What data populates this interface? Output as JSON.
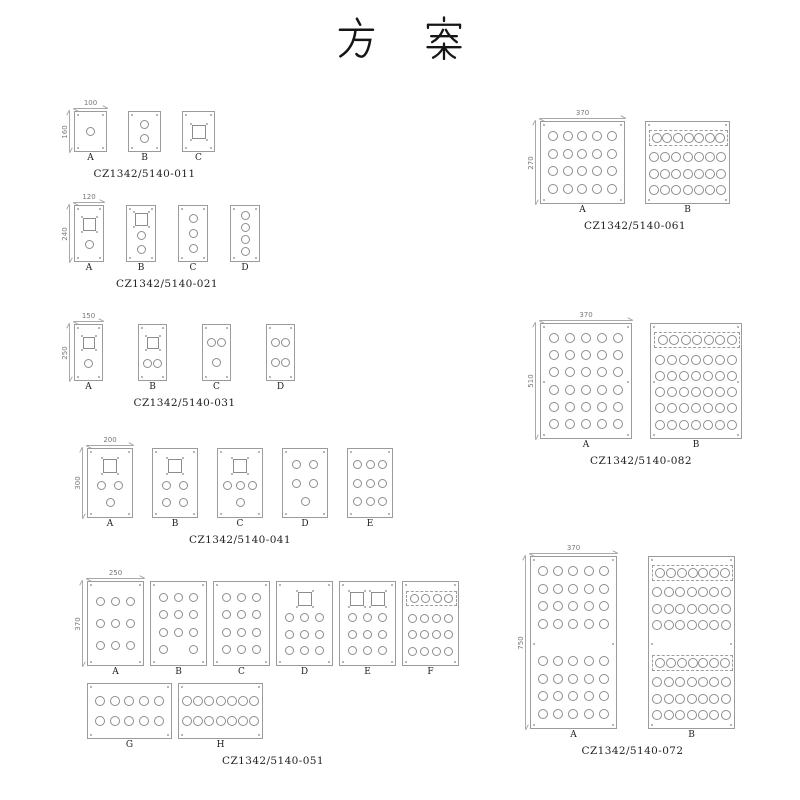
{
  "title": "方 案",
  "colors": {
    "line": "#9b9b9b",
    "hole": "#8d8d8d",
    "text": "#222222",
    "dim": "#787878"
  },
  "groups": [
    {
      "code": "CZ1342/5140-011",
      "dim_width": "100",
      "dim_height": "160",
      "layout": {
        "x": 62,
        "y": 100
      },
      "panelRows": [
        {
          "w": 33,
          "h": 41,
          "gap": 21,
          "circ": 9,
          "sq": 14,
          "panels": [
            {
              "letter": "A",
              "rows": [
                "c"
              ]
            },
            {
              "letter": "B",
              "rows": [
                "c",
                "c"
              ]
            },
            {
              "letter": "C",
              "rows": [
                "s"
              ]
            }
          ]
        }
      ]
    },
    {
      "code": "CZ1342/5140-021",
      "dim_width": "120",
      "dim_height": "240",
      "layout": {
        "x": 62,
        "y": 194
      },
      "panelRows": [
        {
          "w": 30,
          "h": 57,
          "gap": 22,
          "circ": 9,
          "sq": 13,
          "panels": [
            {
              "letter": "A",
              "rows": [
                "s",
                "c"
              ]
            },
            {
              "letter": "B",
              "rows": [
                "s",
                "c",
                "c"
              ]
            },
            {
              "letter": "C",
              "rows": [
                "c",
                "c",
                "c"
              ]
            },
            {
              "letter": "D",
              "rows": [
                "c",
                "c",
                "c",
                "c"
              ]
            }
          ]
        }
      ]
    },
    {
      "code": "CZ1342/5140-031",
      "dim_width": "150",
      "dim_height": "250",
      "layout": {
        "x": 62,
        "y": 313
      },
      "panelRows": [
        {
          "w": 29,
          "h": 57,
          "gap": 35,
          "circ": 9,
          "sq": 12,
          "panels": [
            {
              "letter": "A",
              "rows": [
                "s",
                "c"
              ]
            },
            {
              "letter": "B",
              "rows": [
                "s",
                "cc"
              ]
            },
            {
              "letter": "C",
              "rows": [
                "cc",
                "c"
              ]
            },
            {
              "letter": "D",
              "rows": [
                "cc",
                "cc"
              ]
            }
          ]
        }
      ]
    },
    {
      "code": "CZ1342/5140-041",
      "dim_width": "200",
      "dim_height": "300",
      "layout": {
        "x": 75,
        "y": 437
      },
      "panelRows": [
        {
          "w": 46,
          "h": 70,
          "gap": 19,
          "circ": 9,
          "sq": 14,
          "panels": [
            {
              "letter": "A",
              "rows": [
                "s",
                "cc",
                "c"
              ]
            },
            {
              "letter": "B",
              "rows": [
                "s",
                "cc",
                "cc"
              ]
            },
            {
              "letter": "C",
              "rows": [
                "s",
                "ccc",
                "c"
              ]
            },
            {
              "letter": "D",
              "rows": [
                "cc",
                "cc",
                "c"
              ]
            },
            {
              "letter": "E",
              "rows": [
                "ccc",
                "ccc",
                "ccc"
              ]
            }
          ]
        }
      ]
    },
    {
      "code": "CZ1342/5140-051",
      "dim_width": "250",
      "dim_height": "370",
      "layout": {
        "x": 75,
        "y": 570
      },
      "panelRows": [
        {
          "w": 57,
          "h": 85,
          "gap": 6,
          "circ": 9,
          "sq": 14,
          "panels": [
            {
              "letter": "A",
              "rows": [
                "ccc",
                "ccc",
                "ccc"
              ]
            },
            {
              "letter": "B",
              "rows": [
                "ccc",
                "ccc",
                "ccc",
                "c_c"
              ]
            },
            {
              "letter": "C",
              "rows": [
                "ccc",
                "ccc",
                "ccc",
                "ccc"
              ]
            },
            {
              "letter": "D",
              "rows": [
                "s",
                "ccc",
                "ccc",
                "ccc"
              ]
            },
            {
              "letter": "E",
              "rows": [
                "ss",
                "ccc",
                "ccc",
                "ccc"
              ]
            },
            {
              "letter": "F",
              "rows": [
                "d:cccc",
                "cccc",
                "cccc",
                "cccc"
              ]
            }
          ]
        },
        {
          "w": 85,
          "h": 56,
          "gap": 6,
          "circ": 10,
          "sq": 14,
          "panels": [
            {
              "letter": "G",
              "rows": [
                "ccccc",
                "ccccc"
              ]
            },
            {
              "letter": "H",
              "rows": [
                "ccccccc",
                "ccccccc"
              ]
            }
          ]
        }
      ]
    },
    {
      "code": "CZ1342/5140-061",
      "dim_width": "370",
      "dim_height": "270",
      "layout": {
        "x": 528,
        "y": 110
      },
      "panelRows": [
        {
          "w": 85,
          "h": 83,
          "gap": 20,
          "circ": 10,
          "sq": 14,
          "panels": [
            {
              "letter": "A",
              "rows": [
                "ccccc",
                "ccccc",
                "ccccc",
                "ccccc"
              ]
            },
            {
              "letter": "B",
              "rows": [
                "d:ccccccc",
                "ccccccc",
                "ccccccc",
                "ccccccc"
              ]
            }
          ]
        }
      ]
    },
    {
      "code": "CZ1342/5140-082",
      "dim_width": "370",
      "dim_height": "510",
      "mid_screws": true,
      "layout": {
        "x": 528,
        "y": 312
      },
      "panelRows": [
        {
          "w": 92,
          "h": 116,
          "gap": 18,
          "circ": 10,
          "sq": 14,
          "panels": [
            {
              "letter": "A",
              "rows": [
                "ccccc",
                "ccccc",
                "ccccc",
                "ccccc",
                "ccccc",
                "ccccc"
              ]
            },
            {
              "letter": "B",
              "rows": [
                "d:ccccccc",
                "ccccccc",
                "ccccccc",
                "ccccccc",
                "ccccccc",
                "ccccccc"
              ]
            }
          ]
        }
      ]
    },
    {
      "code": "CZ1342/5140-072",
      "dim_width": "370",
      "dim_height": "750",
      "mid_screws": true,
      "layout": {
        "x": 518,
        "y": 545
      },
      "panelRows": [
        {
          "w": 87,
          "h": 173,
          "gap": 31,
          "circ": 10,
          "sq": 14,
          "panels": [
            {
              "letter": "A",
              "rows": [
                "ccccc",
                "ccccc",
                "ccccc",
                "ccccc",
                "g",
                "ccccc",
                "ccccc",
                "ccccc",
                "ccccc"
              ]
            },
            {
              "letter": "B",
              "rows": [
                "d:ccccccc",
                "ccccccc",
                "ccccccc",
                "ccccccc",
                "g",
                "d:ccccccc",
                "ccccccc",
                "ccccccc",
                "ccccccc"
              ]
            }
          ]
        }
      ]
    }
  ]
}
